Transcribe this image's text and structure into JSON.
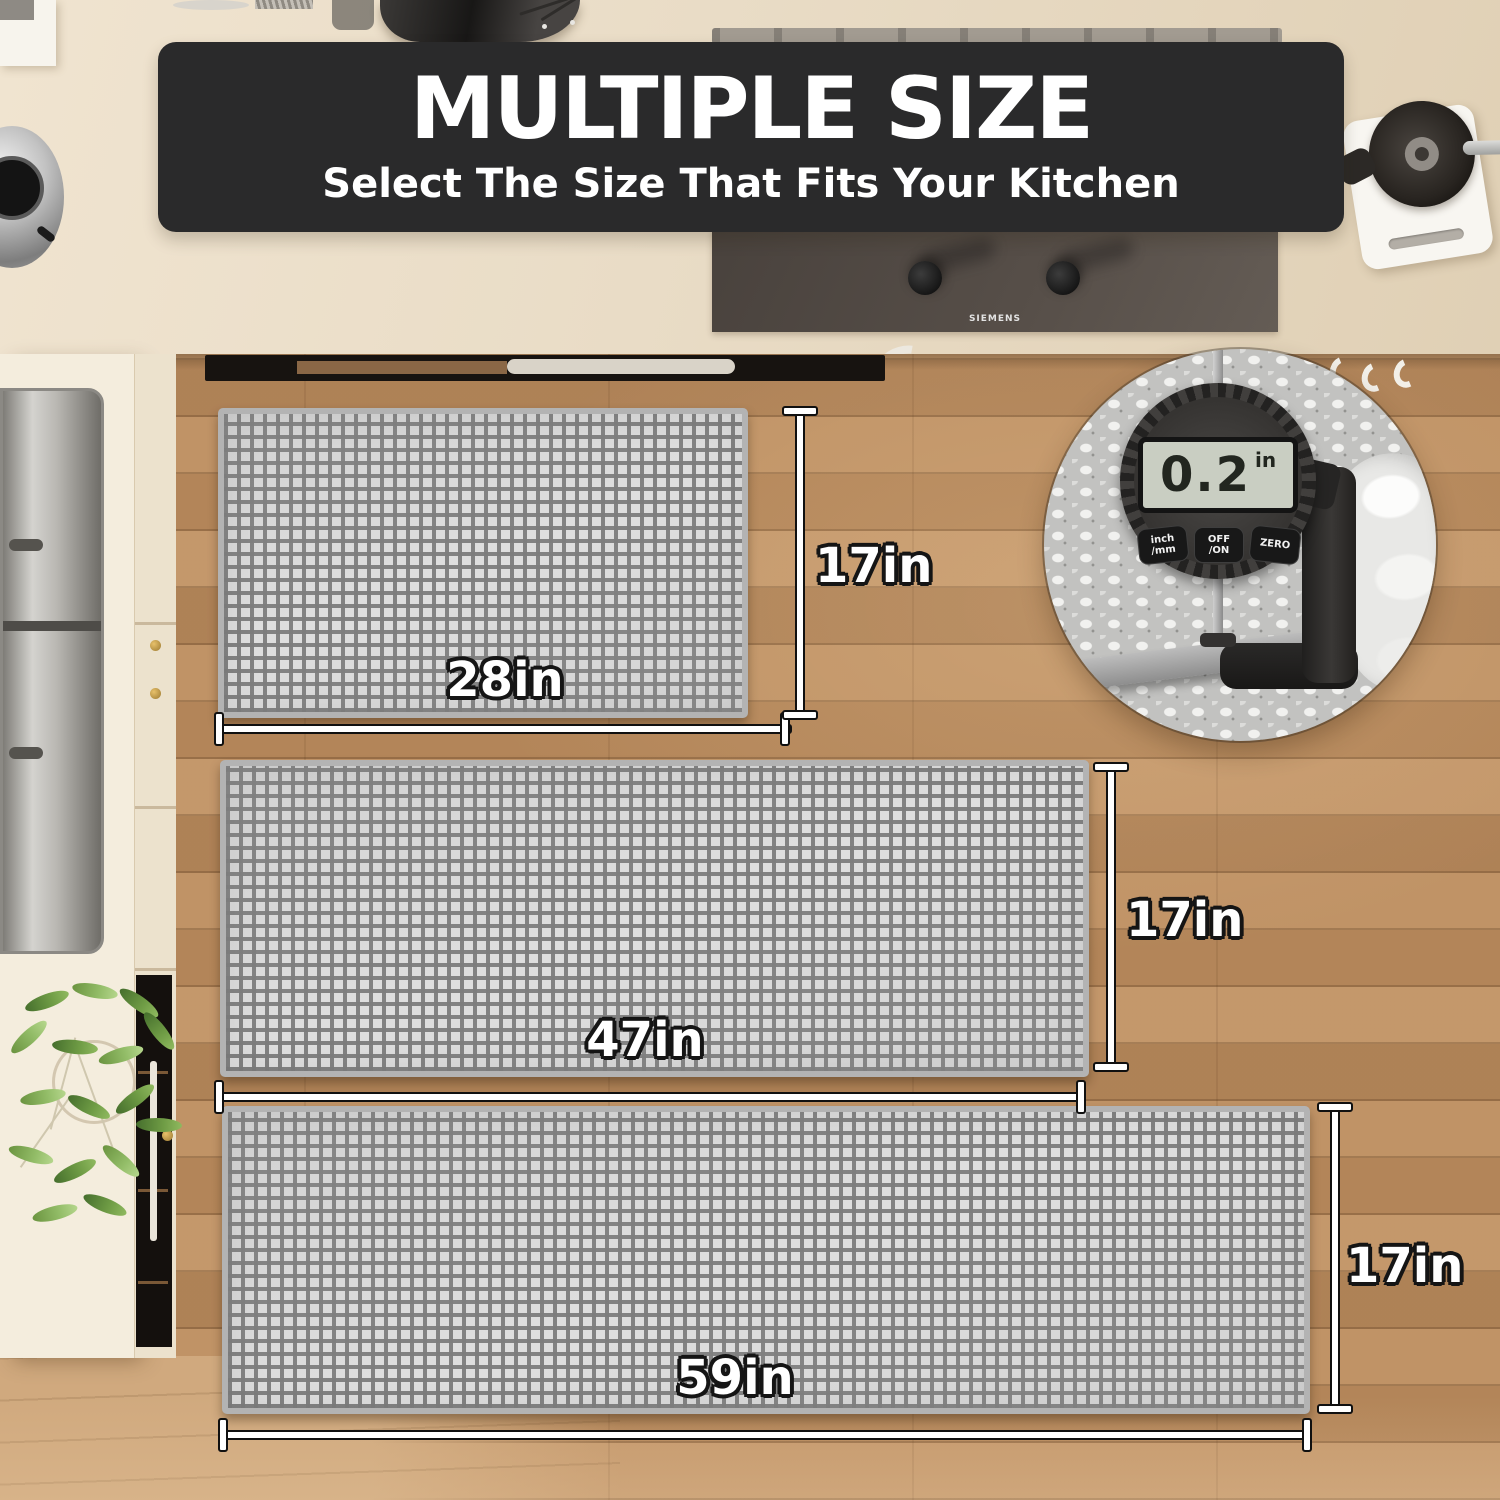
{
  "banner": {
    "title": "MULTIPLE SIZE",
    "subtitle": "Select The Size That Fits Your Kitchen"
  },
  "cooktop": {
    "brand": "SIEMENS"
  },
  "mats": [
    {
      "width_label": "28in",
      "height_label": "17in"
    },
    {
      "width_label": "47in",
      "height_label": "17in"
    },
    {
      "width_label": "59in",
      "height_label": "17in"
    }
  ],
  "thickness_inset": {
    "display_value": "0.2",
    "display_unit": "in",
    "buttons": [
      {
        "line1": "inch",
        "line2": "/mm"
      },
      {
        "line1": "OFF",
        "line2": "/ON"
      },
      {
        "line1": "ZERO",
        "line2": ""
      }
    ]
  },
  "colors": {
    "banner_bg": "#2a2a2b",
    "mat_gray": "#b3b3b3",
    "mat_square": "#ededed",
    "wood_floor": "#bd8e60",
    "counter": "#e9dcc6",
    "dim_line": "#ffffff",
    "dim_outline": "#101010"
  }
}
